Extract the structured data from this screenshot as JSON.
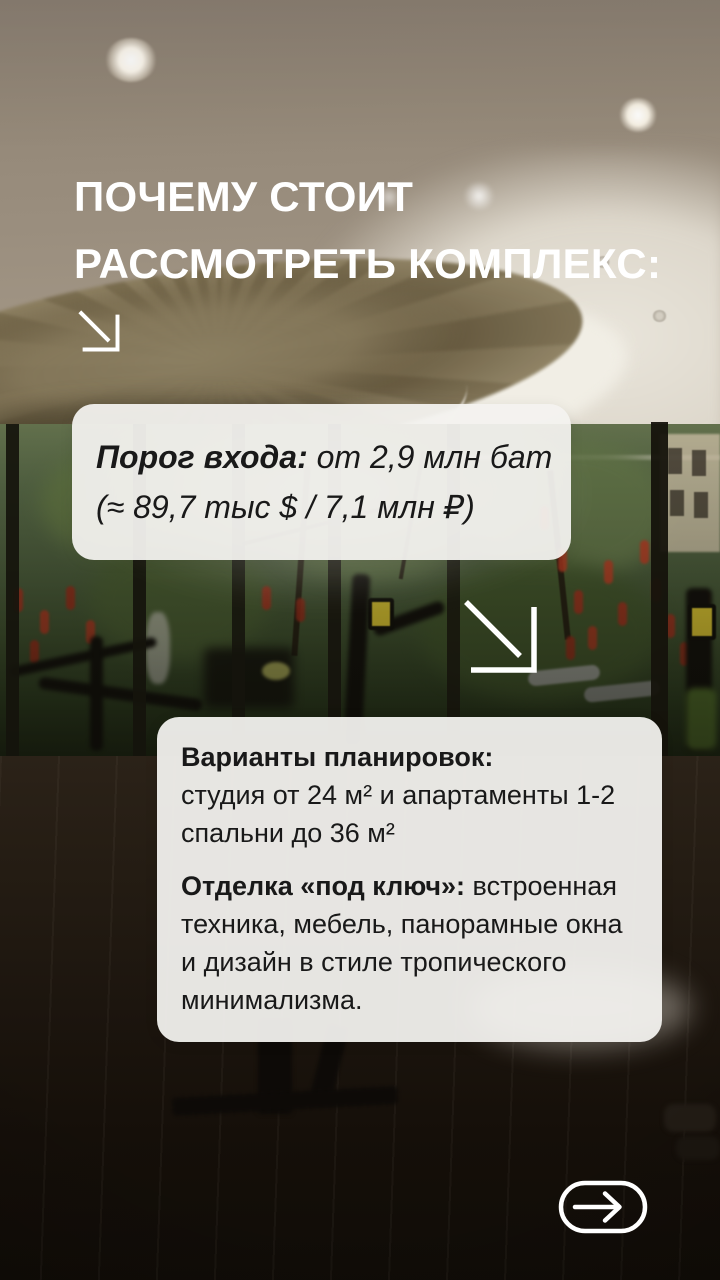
{
  "headline": {
    "line1": "ПОЧЕМУ СТОИТ",
    "line2": "РАССМОТРЕТЬ КОМПЛЕКС:"
  },
  "price_card": {
    "label": "Порог входа:",
    "value_line1": "от 2,9 млн бат",
    "value_line2": "(≈ 89,7 тыс $ / 7,1 млн ₽)"
  },
  "details_card": {
    "layouts_label": "Варианты планировок:",
    "layouts_line1": "студия от 24 м² и апартаменты 1-2",
    "layouts_line2": "спальни до 36 м²",
    "finishing_label": "Отделка «под ключ»:",
    "finishing_line1_rest": "встроенная",
    "finishing_line2": "техника, мебель, панорамные окна",
    "finishing_line3": "и дизайн в стиле тропического",
    "finishing_line4": "минимализма."
  },
  "icons": {
    "arrow_top": "arrow-down-right",
    "arrow_middle": "arrow-down-right",
    "next_button": "arrow-right-in-pill"
  },
  "colors": {
    "headline_text": "#ffffff",
    "card_background": "#f3f2ef",
    "card_text": "#191919",
    "icon_stroke": "#ffffff"
  }
}
